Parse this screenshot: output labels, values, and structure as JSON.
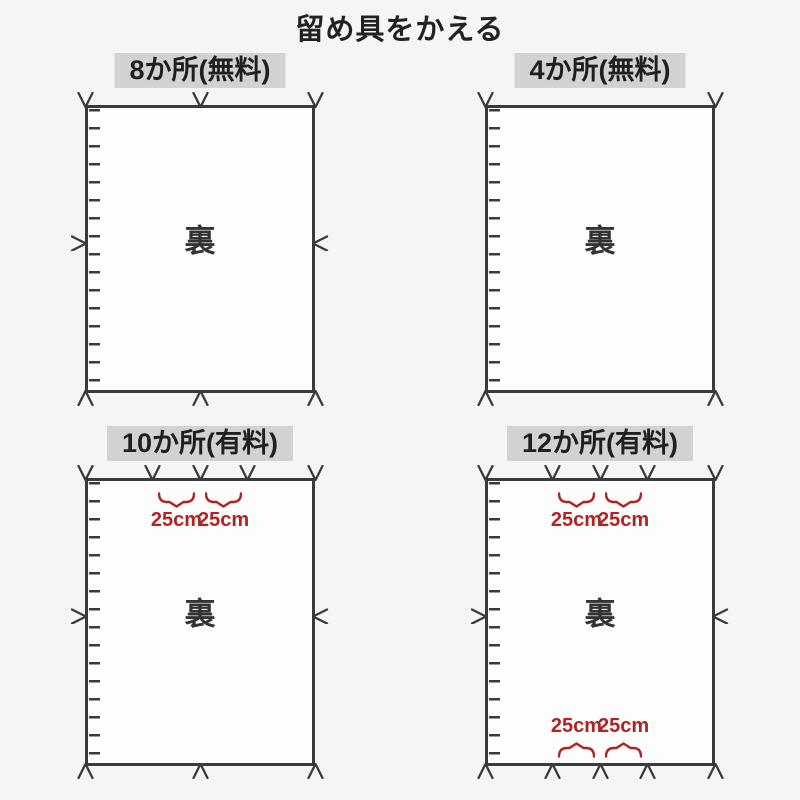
{
  "page": {
    "title": "留め具をかえる"
  },
  "colors": {
    "background": "#f5f5f5",
    "line": "#3a3a3a",
    "accent_red": "#b22222",
    "header_bg": "#d2d2d2",
    "rect_fill": "#fdfdfd"
  },
  "panels": [
    {
      "label": "8か所(無料)",
      "back_label": "裏",
      "top_marks": [
        0,
        0.5,
        1
      ],
      "bottom_marks": [
        0,
        0.5,
        1
      ],
      "left_mid_mark": true,
      "right_mid_mark": true,
      "top_measurements": [],
      "bottom_measurements": []
    },
    {
      "label": "4か所(無料)",
      "back_label": "裏",
      "top_marks": [
        0,
        1
      ],
      "bottom_marks": [
        0,
        1
      ],
      "left_mid_mark": false,
      "right_mid_mark": false,
      "top_measurements": [],
      "bottom_measurements": []
    },
    {
      "label": "10か所(有料)",
      "back_label": "裏",
      "top_marks": [
        0,
        0.295,
        0.5,
        0.705,
        1
      ],
      "bottom_marks": [
        0,
        0.5,
        1
      ],
      "left_mid_mark": true,
      "right_mid_mark": true,
      "top_measurements": [
        {
          "from": 0.295,
          "to": 0.5,
          "label": "25cm"
        },
        {
          "from": 0.5,
          "to": 0.705,
          "label": "25cm"
        }
      ],
      "bottom_measurements": []
    },
    {
      "label": "12か所(有料)",
      "back_label": "裏",
      "top_marks": [
        0,
        0.295,
        0.5,
        0.705,
        1
      ],
      "bottom_marks": [
        0,
        0.295,
        0.5,
        0.705,
        1
      ],
      "left_mid_mark": true,
      "right_mid_mark": true,
      "top_measurements": [
        {
          "from": 0.295,
          "to": 0.5,
          "label": "25cm"
        },
        {
          "from": 0.5,
          "to": 0.705,
          "label": "25cm"
        }
      ],
      "bottom_measurements": [
        {
          "from": 0.295,
          "to": 0.5,
          "label": "25cm"
        },
        {
          "from": 0.5,
          "to": 0.705,
          "label": "25cm"
        }
      ]
    }
  ]
}
